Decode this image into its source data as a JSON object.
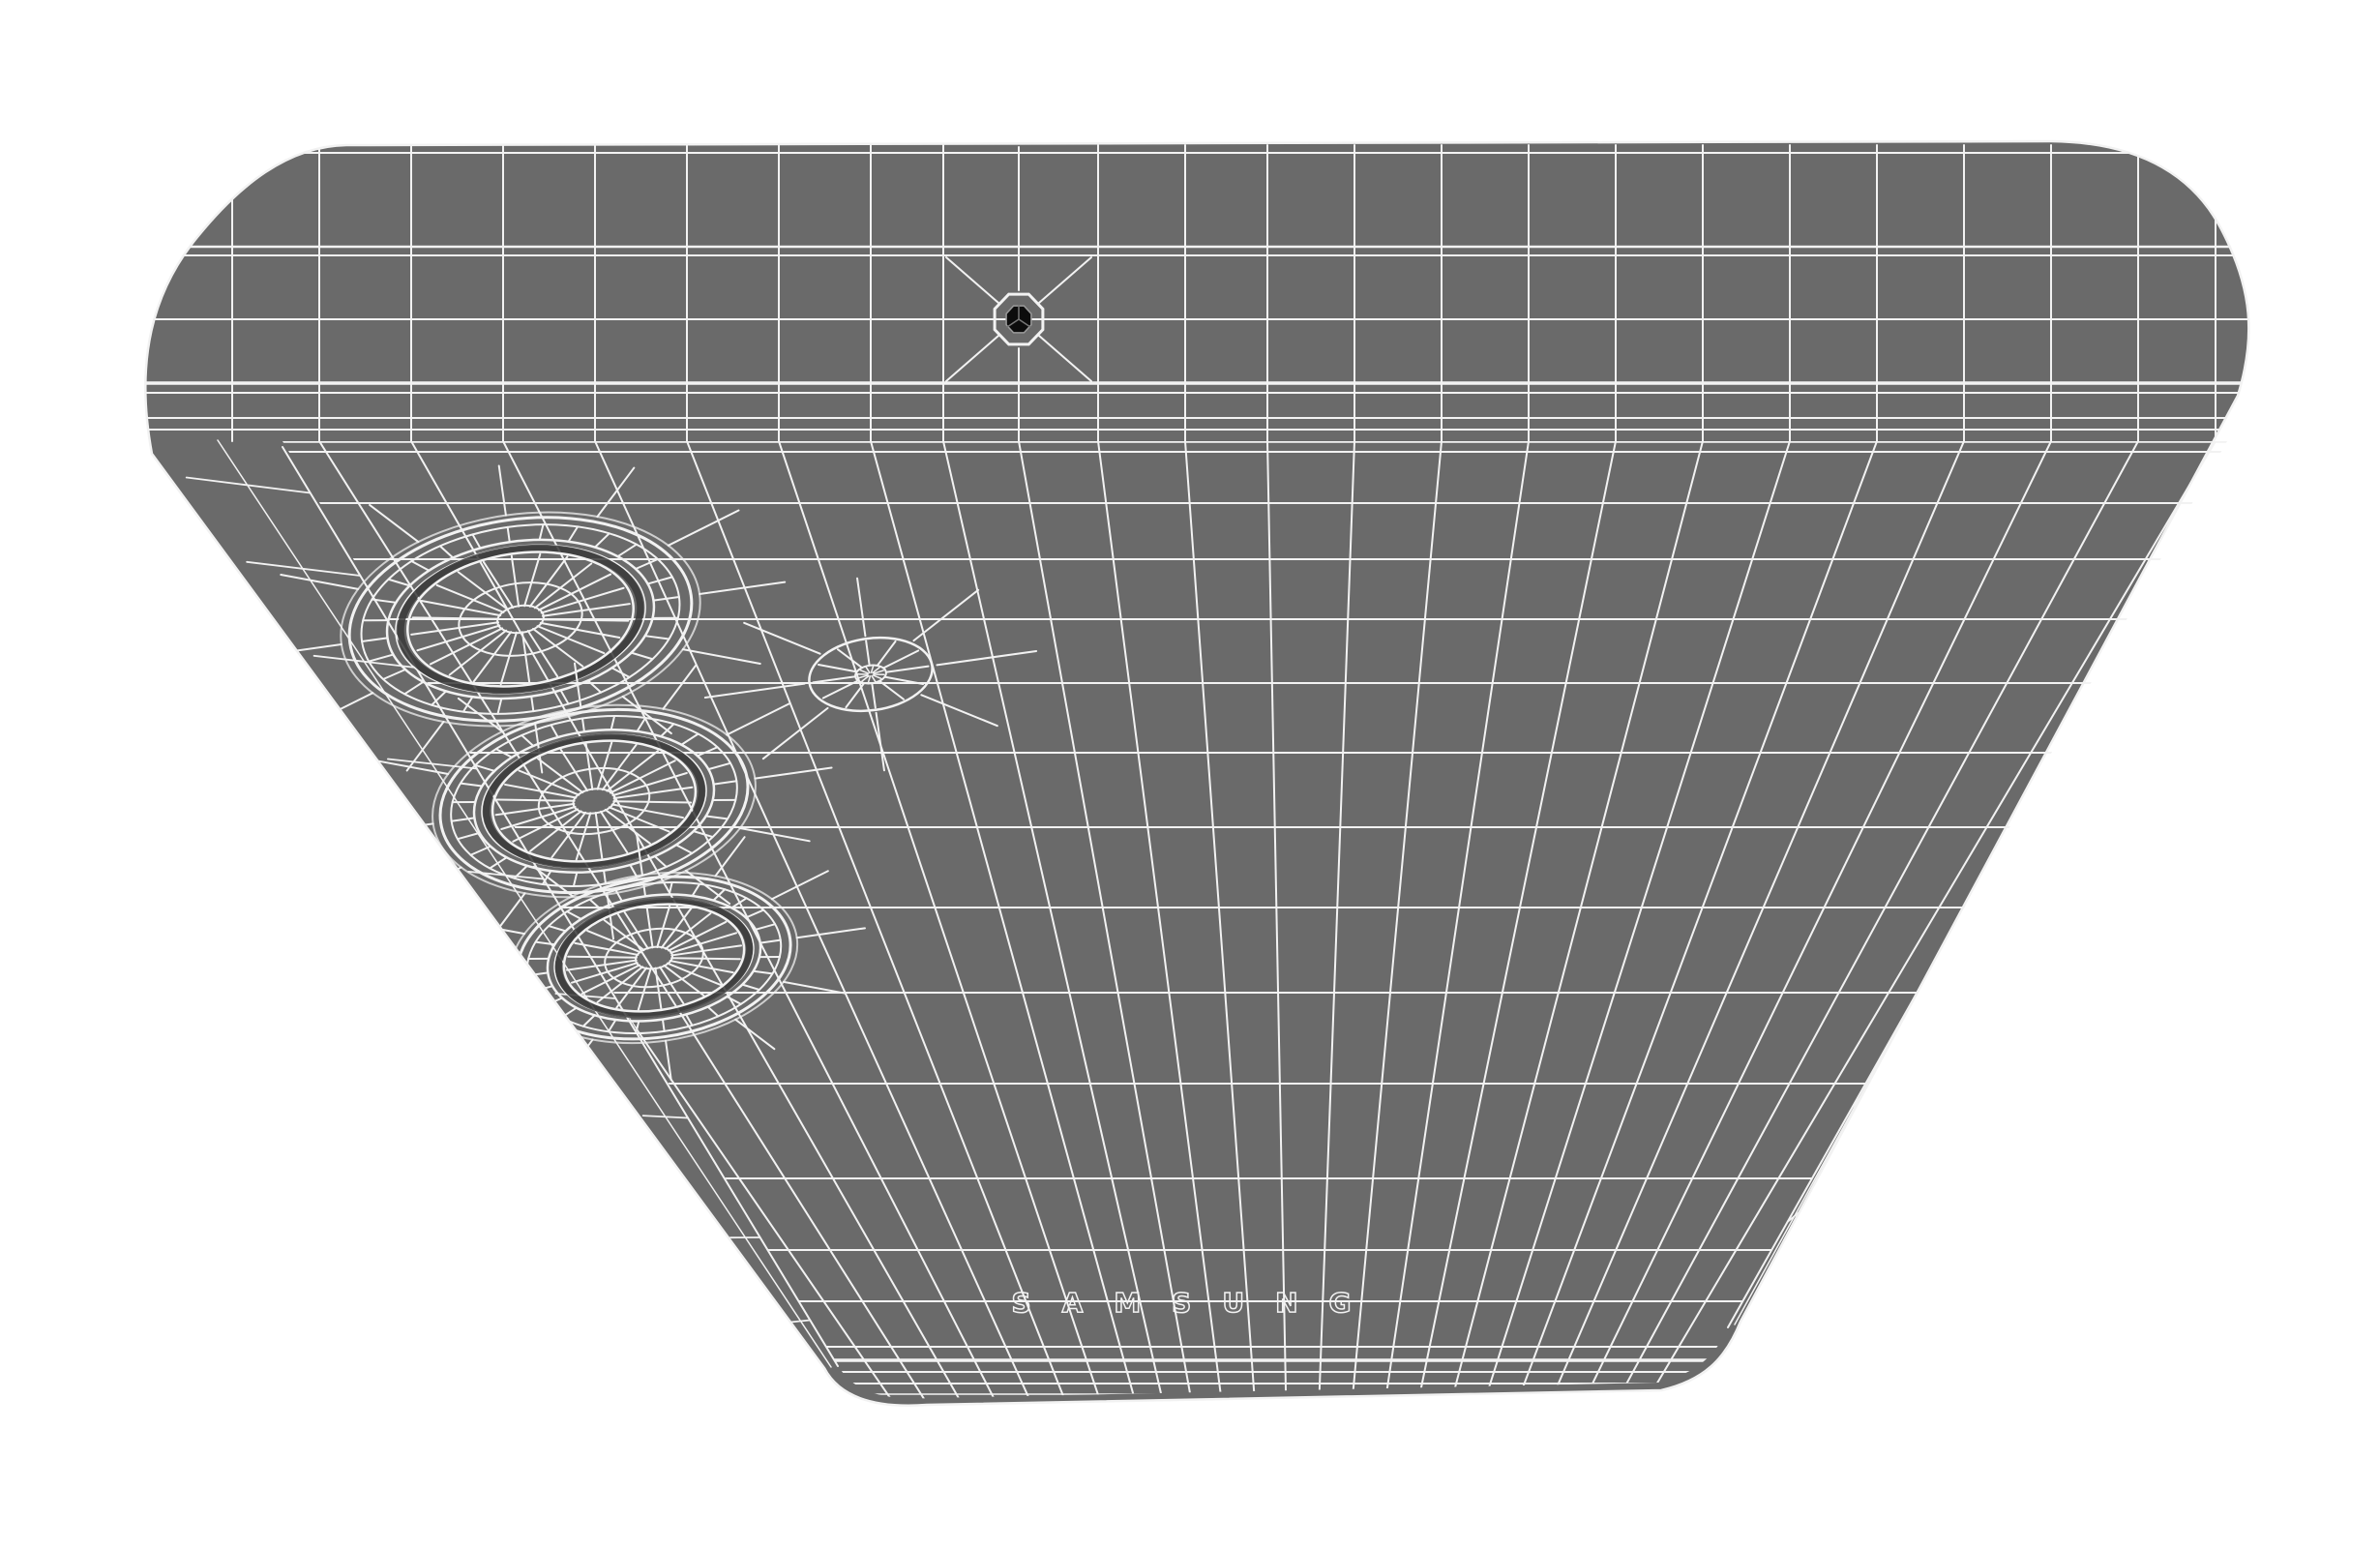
{
  "model": {
    "brand_label": "SAMSUNG",
    "camera_lens_count": 3,
    "colors": {
      "background": "#ffffff",
      "body": "#6a6a6a",
      "wire": "#f2f2f2",
      "shadow": "#383838",
      "recess": "#4f4f4f",
      "hole": "#141414"
    }
  }
}
